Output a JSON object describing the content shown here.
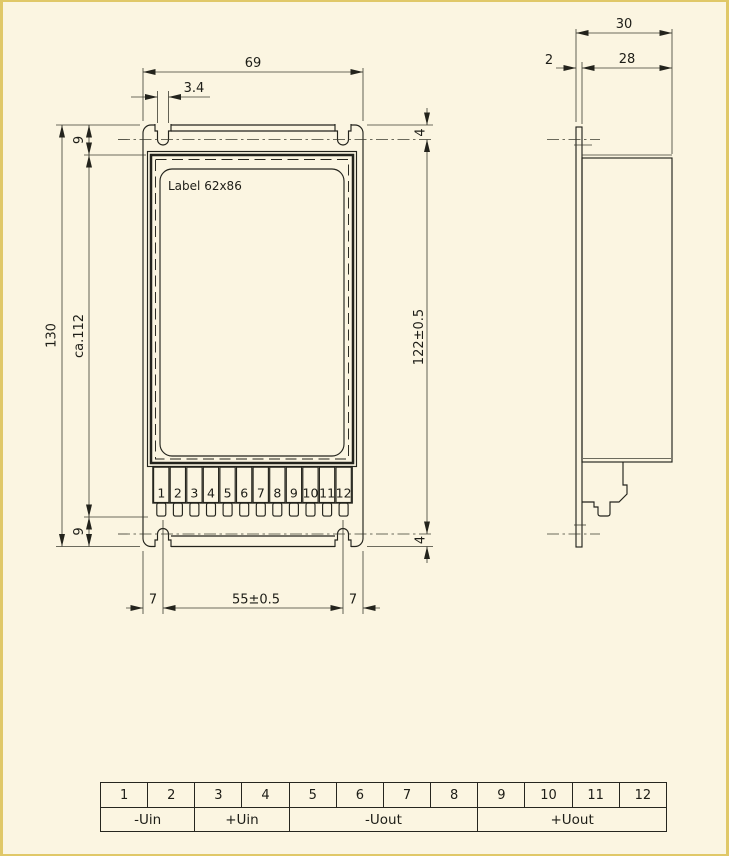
{
  "front": {
    "label": "Label 62x86",
    "terminals": [
      "1",
      "2",
      "3",
      "4",
      "5",
      "6",
      "7",
      "8",
      "9",
      "10",
      "11",
      "12"
    ],
    "dims": {
      "width": "69",
      "slot_width": "3.4",
      "height": "130",
      "body_height": "ca.112",
      "margin_top": "9",
      "margin_bottom": "9",
      "slot_offset_top": "4",
      "slot_offset_bottom": "4",
      "slot_span": "122±0.5",
      "pitch": "55±0.5",
      "edge_left": "7",
      "edge_right": "7"
    }
  },
  "side": {
    "dims": {
      "depth_total": "30",
      "panel_thickness": "2",
      "body_depth": "28"
    }
  },
  "pin_table": {
    "pins": [
      "1",
      "2",
      "3",
      "4",
      "5",
      "6",
      "7",
      "8",
      "9",
      "10",
      "11",
      "12"
    ],
    "groups": [
      {
        "label": "-Uin",
        "span": 2
      },
      {
        "label": "+Uin",
        "span": 2
      },
      {
        "label": "-Uout",
        "span": 4
      },
      {
        "label": "+Uout",
        "span": 4
      }
    ]
  },
  "colors": {
    "background": "#fbf5e1",
    "line": "#23231c",
    "page_edge": "#e0c868"
  }
}
